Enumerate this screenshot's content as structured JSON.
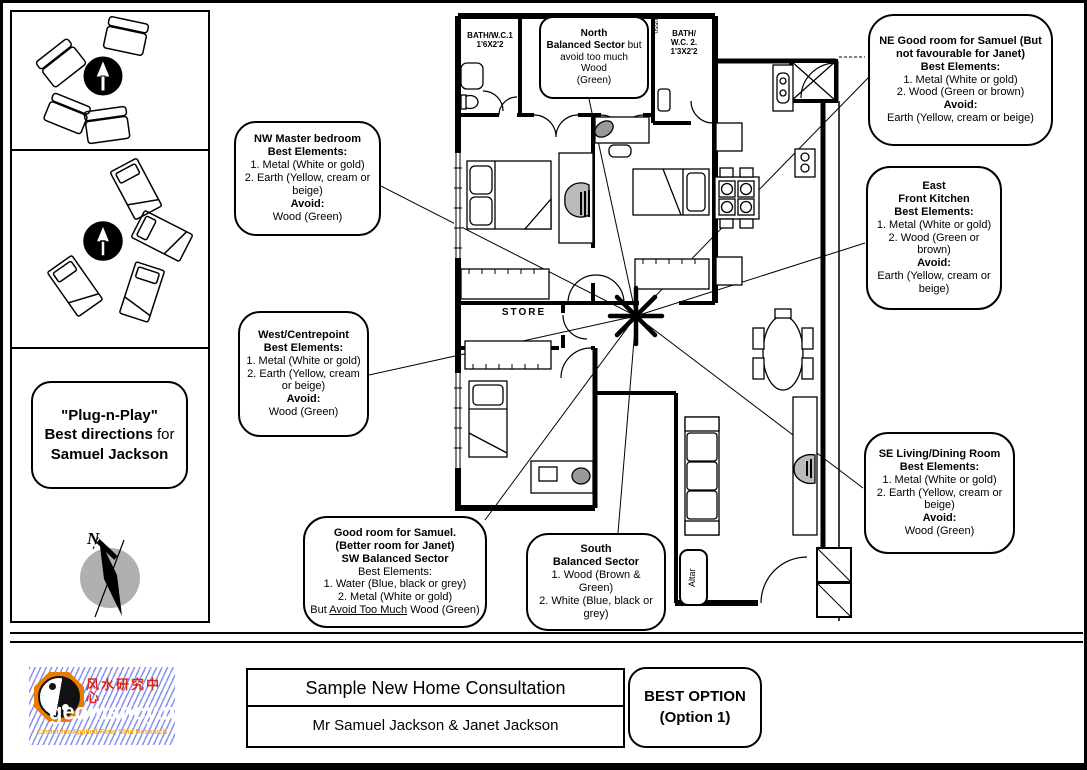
{
  "left_panel": {
    "plug_line1": "\"Plug-n-Play\"",
    "plug_line2_bold": "Best directions",
    "plug_line2_rest": " for",
    "plug_line3": "Samuel Jackson",
    "north_letter": "N"
  },
  "callouts": {
    "north": {
      "title": "North",
      "line2_bold": "Balanced Sector",
      "line2_rest": " but",
      "line3": "avoid too much Wood",
      "line4": "(Green)"
    },
    "ne": {
      "title": "NE Good room for Samuel (But not favourable for Janet)",
      "best_label": "Best Elements:",
      "item1": "1. Metal (White or gold)",
      "item2": "2. Wood (Green or brown)",
      "avoid_label": "Avoid:",
      "avoid": "Earth (Yellow, cream or beige)"
    },
    "nw": {
      "title": "NW Master bedroom",
      "best_label": "Best Elements:",
      "item1": "1. Metal (White or gold)",
      "item2": "2. Earth (Yellow, cream or beige)",
      "avoid_label": "Avoid:",
      "avoid": "Wood (Green)"
    },
    "east": {
      "title": "East",
      "subtitle": "Front Kitchen",
      "best_label": "Best Elements:",
      "item1": "1. Metal (White or gold)",
      "item2": "2. Wood (Green or brown)",
      "avoid_label": "Avoid:",
      "avoid": "Earth (Yellow, cream or beige)"
    },
    "west": {
      "title": "West/Centrepoint",
      "best_label": "Best Elements:",
      "item1": "1. Metal (White or gold)",
      "item2": "2. Earth (Yellow, cream or beige)",
      "avoid_label": "Avoid:",
      "avoid": "Wood (Green)"
    },
    "se": {
      "title": "SE Living/Dining Room",
      "best_label": "Best Elements:",
      "item1": "1. Metal (White or gold)",
      "item2": "2. Earth (Yellow, cream or beige)",
      "avoid_label": "Avoid:",
      "avoid": "Wood (Green)"
    },
    "sw": {
      "title1": "Good room for Samuel.",
      "title2": "(Better room for Janet)",
      "title3": "SW Balanced Sector",
      "best_label": "Best Elements:",
      "item1": "1. Water (Blue, black or grey)",
      "item2": "2. Metal (White or gold)",
      "but_prefix": "But ",
      "but_underline": "Avoid Too Much",
      "but_suffix": " Wood (Green)"
    },
    "south": {
      "title": "South",
      "subtitle": "Balanced Sector",
      "item1": "1. Wood (Brown & Green)",
      "item2": "2. White (Blue, black or grey)"
    }
  },
  "plan": {
    "bath1_line1": "BATH/W.C.1",
    "bath1_line2": "1'6X2'2",
    "bath2_line1": "BATH/",
    "bath2_line2": "W.C. 2.",
    "bath2_line3": "1'3X2'2",
    "store": "STORE",
    "altar": "Altar",
    "door_dim": "0550"
  },
  "footer": {
    "title": "Sample New Home Consultation",
    "subtitle": "Mr Samuel Jackson & Janet Jackson",
    "best_option_line1": "BEST OPTION",
    "best_option_line2": "(Option 1)",
    "logo": {
      "chinese": "风水研究中心",
      "domain": "geomancy.net",
      "tagline": "Center for Applied Feng Shui Research"
    }
  },
  "colors": {
    "logo_bg": "#000022",
    "logo_chinese": "#e02211",
    "logo_domain": "#ffffff",
    "logo_tagline": "#ffaa00",
    "bagua": "#e87c00",
    "compass_gray": "#b0b0b0"
  }
}
